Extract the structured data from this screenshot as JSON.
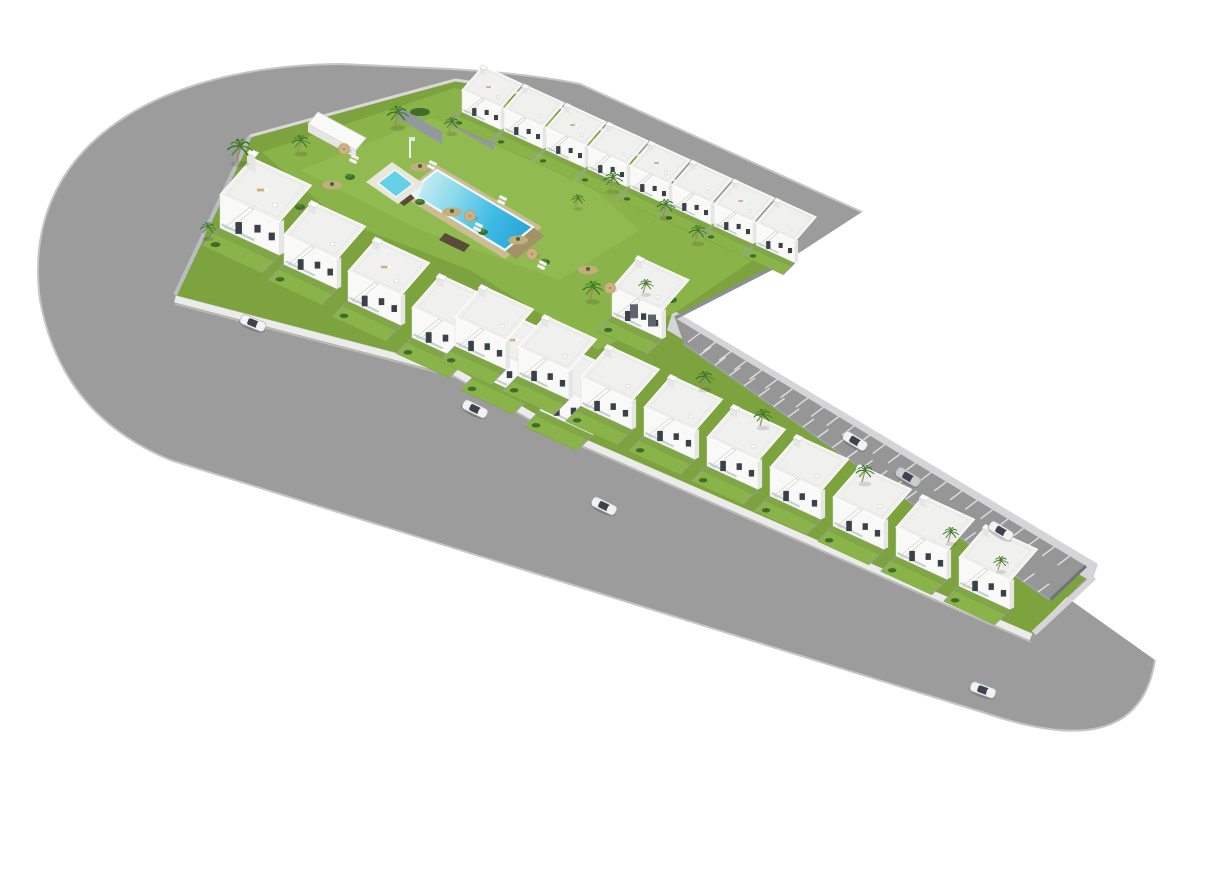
{
  "meta": {
    "type": "3d-architectural-aerial-render",
    "subject": "New-build residential complex of white Mediterranean townhouses around a communal garden with swimming pools, an internal parking street with marked bays, perimeter asphalt roads with rounded corners and scattered cars",
    "canvas": {
      "width": 1221,
      "height": 877
    },
    "background": "#ffffff"
  },
  "palette": {
    "road": "#9d9d9d",
    "road_parking": "#979797",
    "road_curb": "#c6c6c6",
    "sidewalk": "#d5d5d7",
    "stall_line": "#e8e8e8",
    "grass_base": "#7da33f",
    "lawn": "#8ab449",
    "lawn_light": "#97c055",
    "hedge": "#3f6d2b",
    "palm_frond": "#4b8a33",
    "palm_frond_dark": "#3a7026",
    "palm_trunk": "#a08a5f",
    "house_white": "#f9f9f7",
    "house_shade": "#e6e6e4",
    "roof": "#f0f0ee",
    "roof_edge": "#ffffff",
    "window": "#3b4148",
    "stair": "#fbfbf9",
    "stair_edge": "#c9c9c7",
    "gray_panel": "#5d646d",
    "plinth": "#ebebe9",
    "plinth_shadow": "#bcbcba",
    "wall_gray": "#8a9096",
    "garden_wall": "#c2c6c8",
    "pool_deep": "#1f9fd6",
    "pool_mid": "#3fbce4",
    "pool_light": "#8fdcec",
    "pool_pale": "#cdeef5",
    "pool_rim": "#eef9fc",
    "kids_pool": "#66d0e8",
    "deck_stone": "#cbbc92",
    "deck_stone_dark": "#a39268",
    "deck_wood": "#5a4a38",
    "kids_deck": "#e9e7da",
    "gravel": "#c3ad7e",
    "parasol": "#cdb183",
    "lounger": "#f6f6f4",
    "car_white": "#f2f2f2",
    "car_silver": "#c9ccd2",
    "car_glass": "#3e444b"
  },
  "development": {
    "blocks": [
      {
        "id": "upper-block",
        "rows": [
          {
            "id": "back-row",
            "houses": 8
          },
          {
            "id": "front-row",
            "houses": 6
          }
        ],
        "amenities": [
          "communal-lawn",
          "main-pool",
          "kids-pool",
          "pool-deck",
          "storage-shed",
          "sun-loungers",
          "parasols",
          "palm-trees",
          "gravel-planting-beds"
        ]
      },
      {
        "id": "lower-block",
        "rows": [
          {
            "id": "street-row",
            "houses": 9
          }
        ],
        "amenities": [
          "private-gardens",
          "roof-terraces",
          "parking-street"
        ]
      }
    ],
    "house_style": "white two-storey townhouses, flat roofs with terraces, external side staircases, dark window openings, private lawned gardens",
    "end_house": {
      "style": "two-tone white and anthracite end house",
      "count": 1
    }
  },
  "roads": {
    "perimeter_road": {
      "surface": "asphalt",
      "shape": "wraps the site from a rounded top-left corner, along the bottom edge, to a rounded bottom-right corner; upper branch ends in a diagonal cut"
    },
    "parking_street": {
      "stalls_upper_side": 25,
      "stalls_lower_side": 24,
      "marking": "white angled bay lines",
      "dead_end": true
    }
  },
  "pools": {
    "main": {
      "shape": "long rectangle set diagonally",
      "water": "turquoise gradient",
      "surround": "beige stone deck with dark timber edging"
    },
    "kids": {
      "shape": "small square splash pool",
      "deck": "white platform",
      "feature": "pool shower pole"
    }
  },
  "vehicles": [
    {
      "id": "car-1",
      "color_key": "car_white",
      "location": "left perimeter road",
      "x": 253,
      "y": 323,
      "angle": 22
    },
    {
      "id": "car-2",
      "color_key": "car_white",
      "location": "bottom perimeter road",
      "x": 475,
      "y": 409,
      "angle": 26
    },
    {
      "id": "car-3",
      "color_key": "car_white",
      "location": "bottom perimeter road",
      "x": 604,
      "y": 506,
      "angle": 26
    },
    {
      "id": "car-4",
      "color_key": "car_white",
      "location": "parking street",
      "x": 855,
      "y": 441,
      "angle": 31
    },
    {
      "id": "car-5",
      "color_key": "car_silver",
      "location": "parking street",
      "x": 908,
      "y": 477,
      "angle": 31
    },
    {
      "id": "car-6",
      "color_key": "car_white",
      "location": "parking street bay",
      "x": 1001,
      "y": 531,
      "angle": 31
    },
    {
      "id": "car-7",
      "color_key": "car_white",
      "location": "bottom-right road",
      "x": 983,
      "y": 690,
      "angle": 20
    }
  ],
  "layout": {
    "rows": [
      {
        "name": "back-row",
        "start": [
          462,
          112
        ],
        "step": [
          42,
          19
        ],
        "count": 8,
        "scale": 0.78,
        "opts": {
          "furn": true
        }
      },
      {
        "name": "front-row",
        "start": [
          220,
          228
        ],
        "step": [
          64,
          36.5
        ],
        "count": 6,
        "scale": 1.06,
        "opts": {
          "tower_first": true,
          "furn": true
        }
      },
      {
        "name": "street-row",
        "start": [
          455,
          346
        ],
        "step": [
          63,
          30
        ],
        "count": 9,
        "scale": 1.02,
        "opts": {}
      }
    ],
    "end_house": {
      "pos": [
        612,
        316
      ],
      "scale": 1.0
    },
    "palms": [
      [
        237,
        162,
        1.1
      ],
      [
        205,
        237,
        0.7
      ],
      [
        298,
        152,
        0.8
      ],
      [
        395,
        126,
        0.95
      ],
      [
        449,
        132,
        0.7
      ],
      [
        575,
        207,
        0.6
      ],
      [
        610,
        190,
        0.85
      ],
      [
        663,
        216,
        0.8
      ],
      [
        695,
        242,
        0.8
      ],
      [
        590,
        300,
        0.9
      ],
      [
        643,
        293,
        0.65
      ],
      [
        702,
        388,
        0.8
      ],
      [
        760,
        426,
        0.8
      ],
      [
        862,
        482,
        0.8
      ],
      [
        948,
        542,
        0.7
      ],
      [
        998,
        570,
        0.65
      ]
    ],
    "bushes": [
      [
        350,
        177
      ],
      [
        420,
        202
      ],
      [
        483,
        232
      ],
      [
        545,
        262
      ],
      [
        300,
        207
      ],
      [
        640,
        310
      ],
      [
        672,
        300
      ]
    ],
    "gravel": [
      [
        332,
        185
      ],
      [
        452,
        212
      ],
      [
        518,
        240
      ],
      [
        588,
        270
      ],
      [
        646,
        300
      ],
      [
        420,
        167
      ]
    ],
    "parasols": [
      [
        344,
        149
      ],
      [
        470,
        216
      ],
      [
        532,
        254
      ],
      [
        610,
        288
      ]
    ],
    "lounger_pairs": [
      [
        352,
        154
      ],
      [
        430,
        160
      ],
      [
        476,
        222
      ],
      [
        540,
        260
      ],
      [
        500,
        195
      ]
    ],
    "stall_rows": [
      {
        "start": [
          700,
          333
        ],
        "step": [
          15.4,
          9.3
        ],
        "count": 25,
        "stripe": [
          -12,
          9
        ]
      },
      {
        "start": [
          700,
          355
        ],
        "step": [
          14.7,
          10.3
        ],
        "count": 24,
        "stripe": [
          11,
          -8
        ]
      }
    ]
  }
}
